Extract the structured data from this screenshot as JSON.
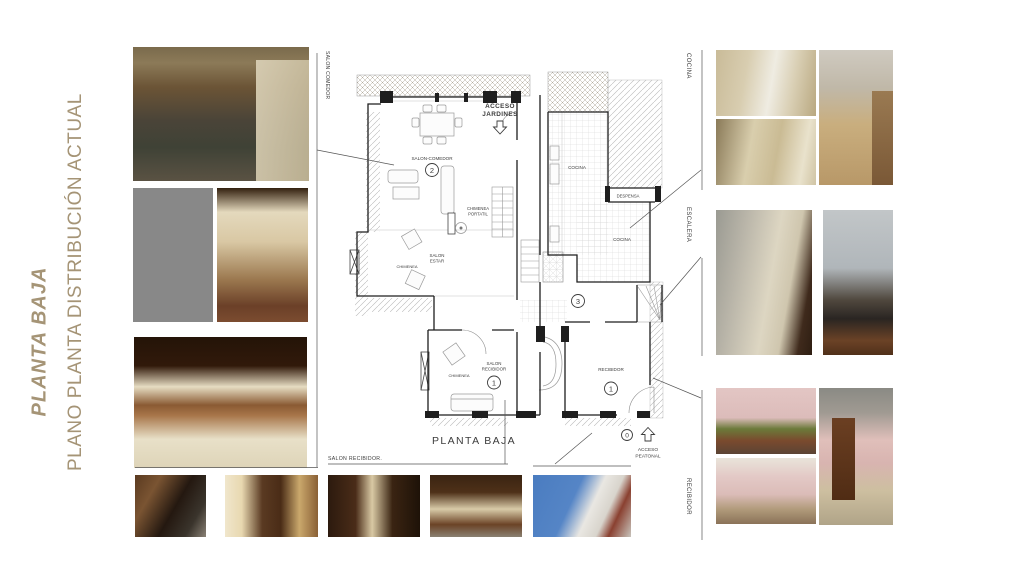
{
  "colors": {
    "accent_tan": "#a59476",
    "plan_wall": "#1e1e1e",
    "plan_label": "#3c3c3c",
    "connector": "#555555"
  },
  "titles": {
    "main": "PLANTA BAJA",
    "subtitle": "PLANO PLANTA DISTRIBUCIÓN ACTUAL"
  },
  "side_labels": {
    "left_top_vertical": "SALON COMEDOR",
    "bottom": "SALON RECIBIDOR.",
    "right_cocina": "COCINA",
    "right_escalera": "ESCALERA",
    "right_recibidor": "RECIBIDOR"
  },
  "plan": {
    "caption": "PLANTA BAJA",
    "labels": {
      "acceso_jardines_1": "ACCESO",
      "acceso_jardines_2": "JARDINES",
      "salon_comedor": "SALON-COMEDOR",
      "chimenea_portatil_1": "CHIMENEA",
      "chimenea_portatil_2": "PORTATIL",
      "cocina_upper": "COCINA",
      "despensa": "DESPENSA",
      "cocina_lower": "COCINA",
      "salon_estar_1": "SALON",
      "salon_estar_2": "ESTAR",
      "chimenea_estar": "CHIMENEA",
      "chimenea_recibidor": "CHIMENEA",
      "salon_recibidor_1": "SALON",
      "salon_recibidor_2": "RECIBIDOR",
      "recibidor": "RECIBIDOR",
      "acceso_peatonal_1": "ACCESO",
      "acceso_peatonal_2": "PEATONAL"
    },
    "numbers": {
      "salon_comedor": "2",
      "escalera_hall": "3",
      "salon_recibidor": "1",
      "recibidor": "1",
      "acceso": "0"
    },
    "icons": {
      "jardines_arrow": "down-hollow-arrow",
      "peatonal_arrow": "up-hollow-arrow"
    }
  },
  "photos": {
    "l1": {
      "label": "salón comedor"
    },
    "l2": {
      "label": "techo artesonado"
    },
    "l3": {
      "label": "salón con chimenea"
    },
    "l4": {
      "label": "galería salón"
    },
    "b1": {
      "label": "barandilla escalera"
    },
    "b2": {
      "label": "salón recibidor"
    },
    "b3": {
      "label": "salón recibidor"
    },
    "b4": {
      "label": "salón recibidor"
    },
    "b5": {
      "label": "fachada acceso"
    },
    "rc1": {
      "label": "cocina"
    },
    "rc2": {
      "label": "cocina"
    },
    "rc3": {
      "label": "cocina"
    },
    "re1": {
      "label": "escalera"
    },
    "re2": {
      "label": "escalera"
    },
    "rr1": {
      "label": "recibidor"
    },
    "rr2": {
      "label": "recibidor"
    },
    "rr3": {
      "label": "recibidor"
    }
  }
}
